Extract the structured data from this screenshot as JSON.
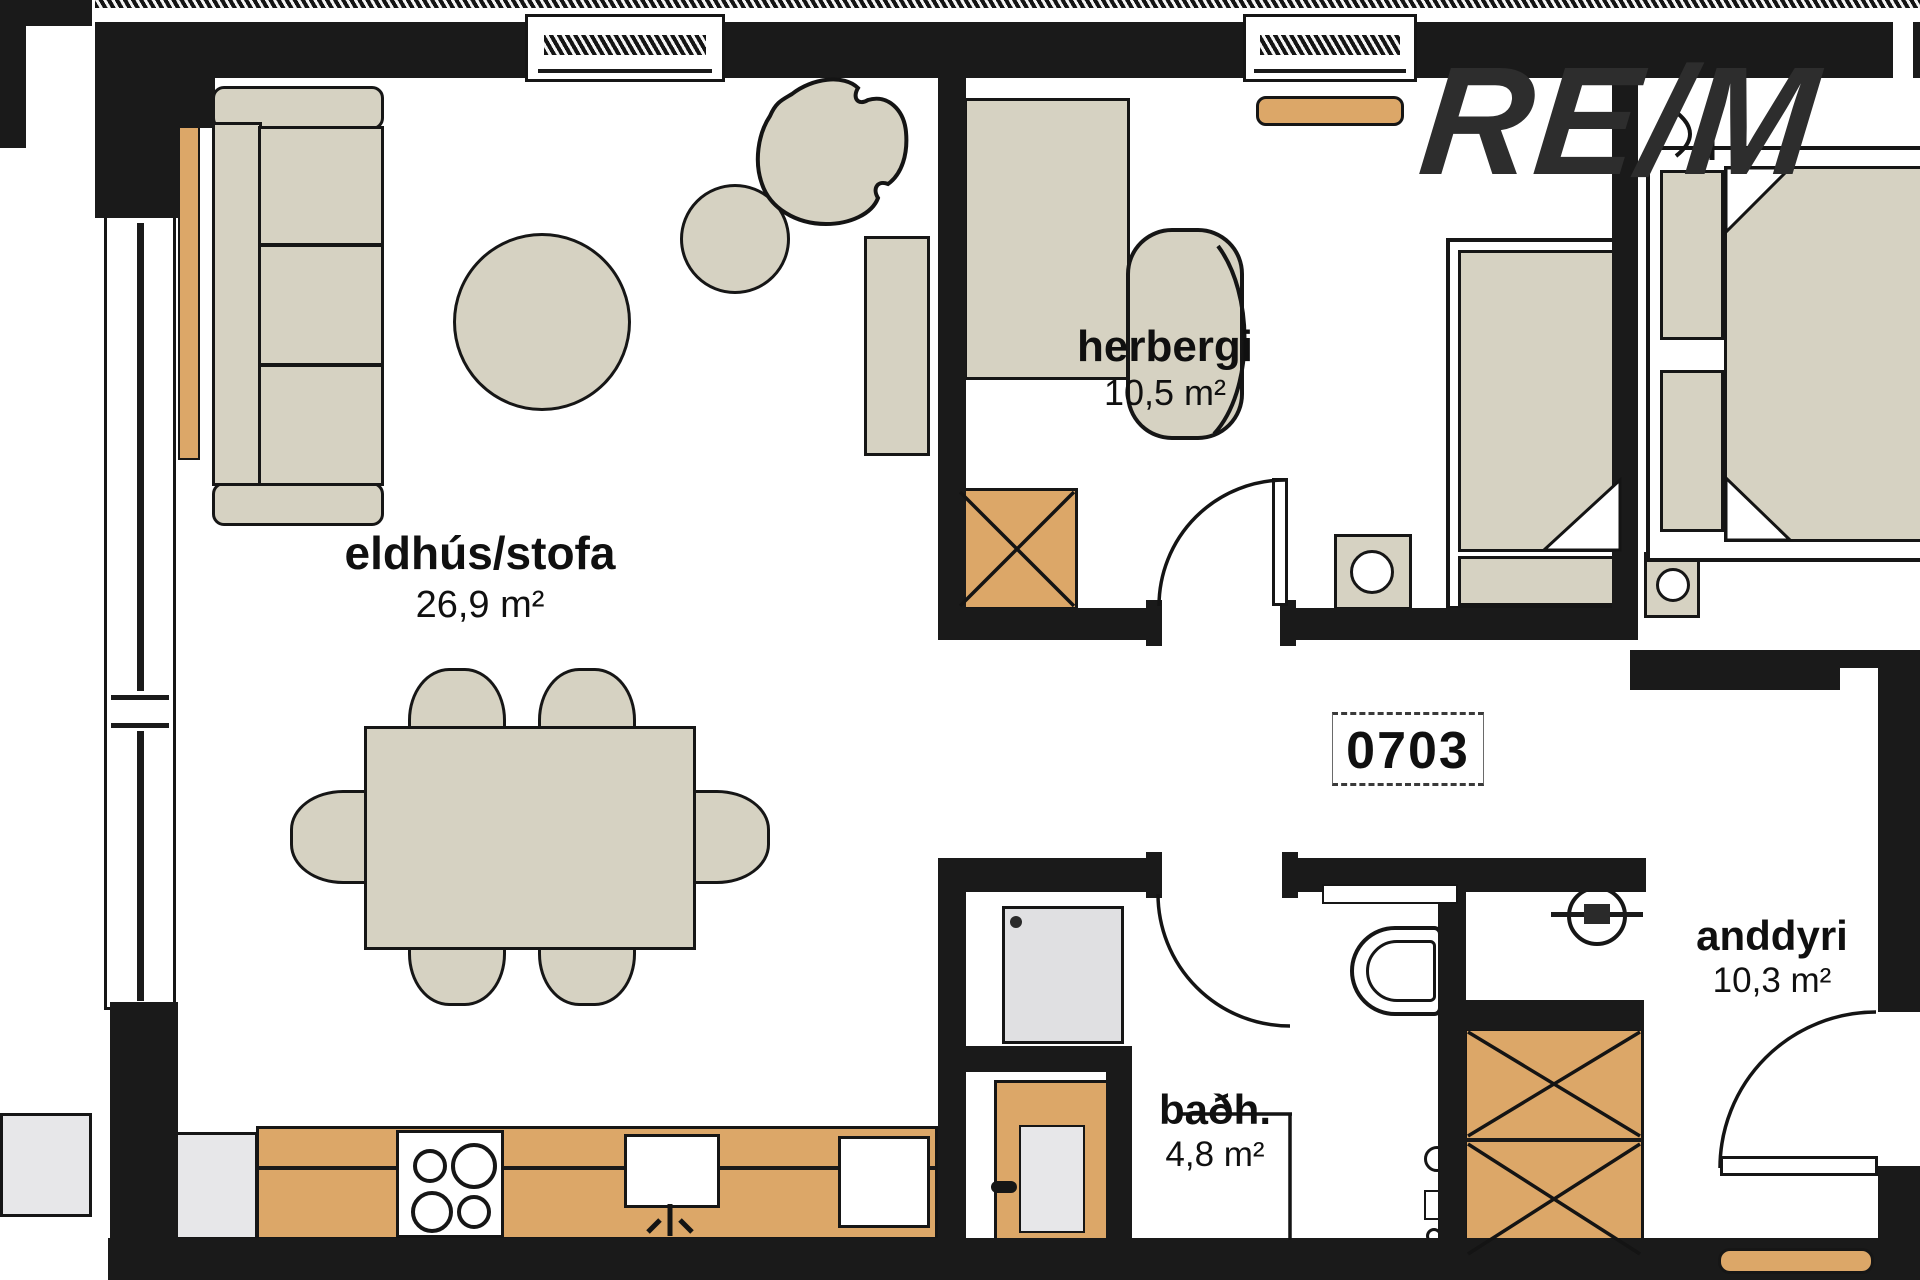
{
  "floorplan": {
    "unit_label": "0703",
    "watermark_text": "RE/M",
    "rooms": [
      {
        "name": "eldhús/stofa",
        "area": "26,9 m²"
      },
      {
        "name": "herbergi",
        "area": "10,5 m²"
      },
      {
        "name": "baðh.",
        "area": "4,8 m²"
      },
      {
        "name": "anddyri",
        "area": "10,3 m²"
      }
    ],
    "colors": {
      "wall": "#1a1a1a",
      "furniture_beige": "#d6d2c2",
      "wood_orange": "#dca768",
      "appliance_gray": "#e7e7e9",
      "background": "#ffffff"
    }
  }
}
